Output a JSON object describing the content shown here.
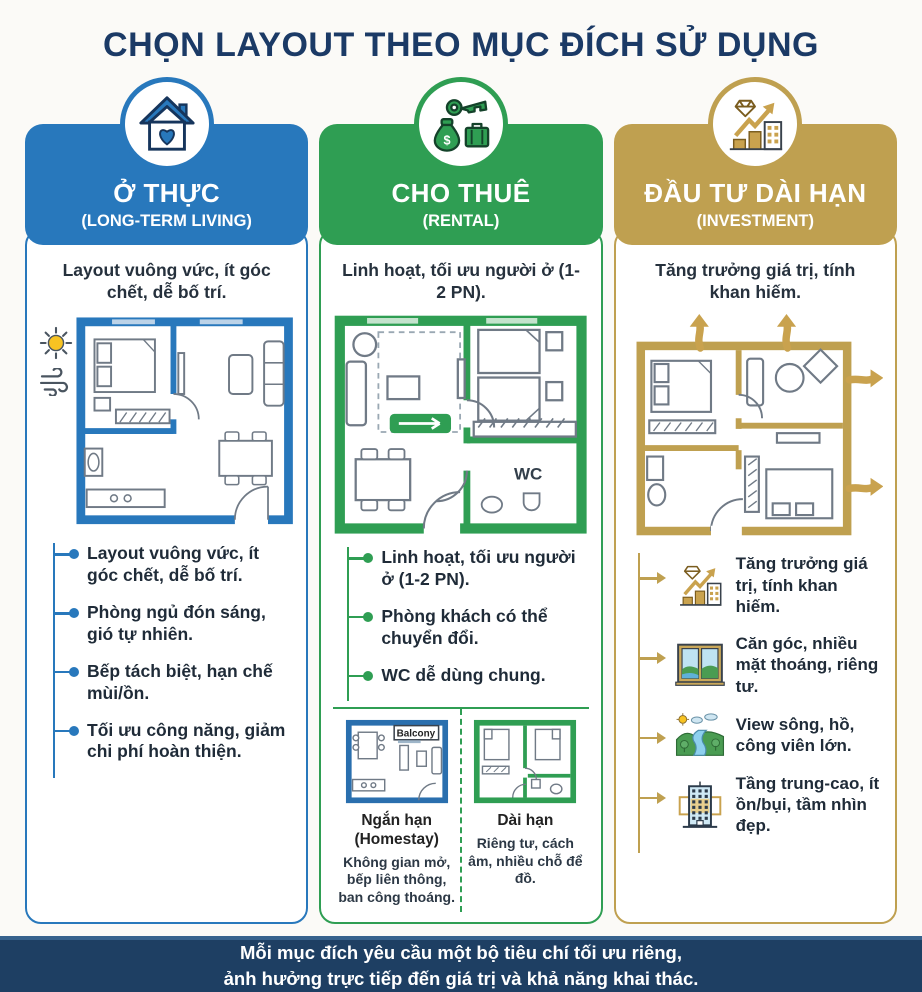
{
  "title": "CHỌN LAYOUT THEO MỤC ĐÍCH SỬ DỤNG",
  "columns": [
    {
      "accent": "#2878bc",
      "icon": "house-heart-icon",
      "header": {
        "title": "Ở THỰC",
        "subtitle": "(LONG-TERM LIVING)"
      },
      "summary": "Layout vuông vức, ít góc chết, dễ bố trí.",
      "bullets": [
        "Layout vuông vức, ít góc chết, dễ bố trí.",
        "Phòng ngủ đón sáng, gió tự nhiên.",
        "Bếp tách biệt, hạn chế mùi/ồn.",
        "Tối ưu công năng, giảm chi phí hoàn thiện."
      ]
    },
    {
      "accent": "#2f9e53",
      "icon": "key-money-icon",
      "header": {
        "title": "CHO THUÊ",
        "subtitle": "(RENTAL)"
      },
      "summary": "Linh hoạt, tối ưu người ở (1-2 PN).",
      "plan_label": "WC",
      "bullets": [
        "Linh hoạt, tối ưu người ở (1-2 PN).",
        "Phòng khách có thể chuyển đổi.",
        "WC dễ dùng chung."
      ],
      "mini_plans": [
        {
          "balcony_label": "Balcony",
          "title": "Ngắn hạn",
          "title2": "(Homestay)",
          "desc": "Không gian mở, bếp liên thông, ban công thoáng."
        },
        {
          "title": "Dài hạn",
          "title2": "",
          "desc": "Riêng tư, cách âm, nhiều chỗ để đồ."
        }
      ]
    },
    {
      "accent": "#bfa050",
      "icon": "investment-growth-icon",
      "header": {
        "title": "ĐẦU TƯ DÀI HẠN",
        "subtitle": "(INVESTMENT)"
      },
      "summary": "Tăng trưởng giá trị, tính khan hiếm.",
      "features": [
        {
          "icon": "growth-chart-icon",
          "text": "Tăng trưởng giá trị, tính khan hiếm."
        },
        {
          "icon": "corner-window-icon",
          "text": "Căn góc, nhiều mặt thoáng, riêng tư."
        },
        {
          "icon": "river-park-view-icon",
          "text": "View sông, hồ, công viên lớn."
        },
        {
          "icon": "mid-high-floor-icon",
          "text": "Tầng trung-cao, ít ồn/bụi, tầm nhìn đẹp."
        }
      ]
    }
  ],
  "footer": {
    "line1": "Mỗi mục đích yêu cầu một bộ tiêu chí tối ưu riêng,",
    "line2": "ảnh hưởng trực tiếp đến giá trị và khả năng khai thác."
  }
}
